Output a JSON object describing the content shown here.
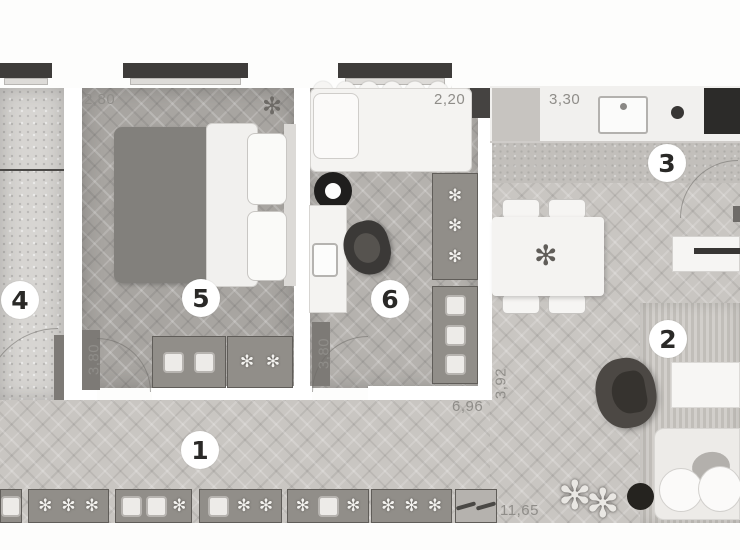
{
  "plan_title": "apartment floor plan",
  "rooms": [
    {
      "number": "1",
      "name": "hallway"
    },
    {
      "number": "2",
      "name": "living-room"
    },
    {
      "number": "3",
      "name": "kitchen"
    },
    {
      "number": "4",
      "name": "balcony"
    },
    {
      "number": "5",
      "name": "bedroom"
    },
    {
      "number": "6",
      "name": "kids-room-office"
    }
  ],
  "dimensions": {
    "bedroom_width": "2,80",
    "kids_room_width": "2,20",
    "kitchen_width": "3,30",
    "bedroom_depth": "3,80",
    "kids_room_depth": "3,80",
    "living_depth": "3,92",
    "corridor_length": "6,96",
    "total_length": "11,65"
  },
  "glyphs": {
    "plant": "✻"
  },
  "colors": {
    "floor_wood_light": "#c9c6c2",
    "floor_wood_dark": "#a8a5a1",
    "concrete": "#d7d5d2",
    "wall_white": "#ffffff",
    "window_frame": "#3e3c3a",
    "cooktop": "#2c2b29",
    "armchair": "#4c4844",
    "duvet": "#82807c",
    "storage_box": "#918e89",
    "label_gray": "#8f8d89"
  }
}
